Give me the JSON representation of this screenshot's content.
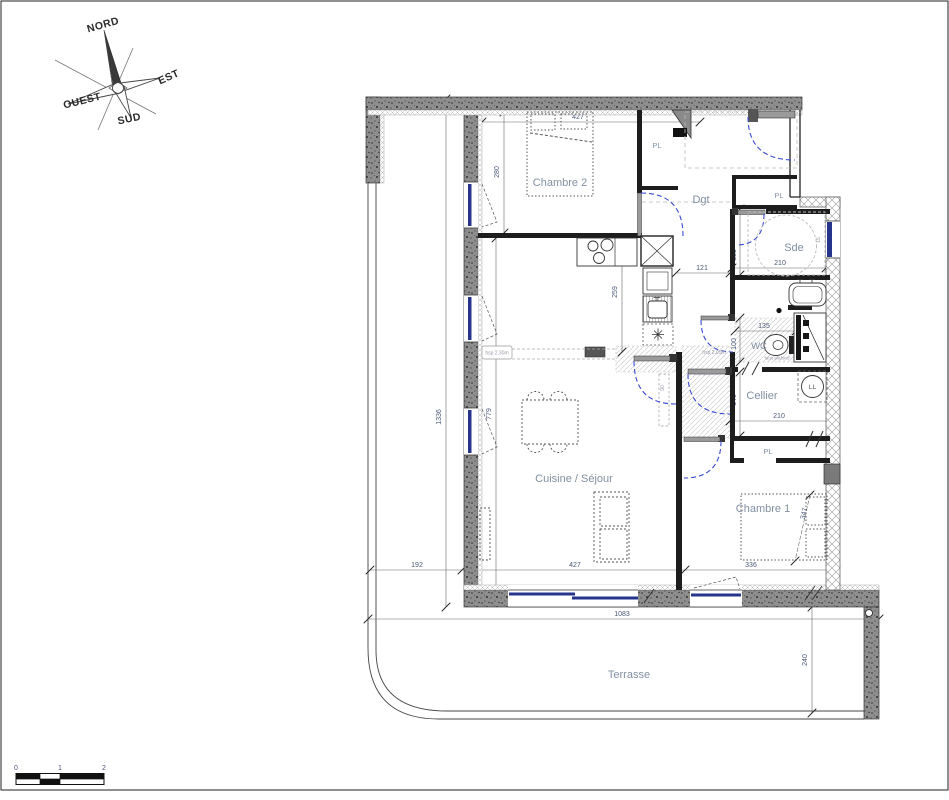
{
  "compass": {
    "north": "NORD",
    "east": "EST",
    "west": "OUEST",
    "south": "SUD"
  },
  "rooms": {
    "chambre2": "Chambre 2",
    "dgt": "Dgt",
    "sde": "Sde",
    "wc": "WC",
    "cellier": "Cellier",
    "cuisine_sejour": "Cuisine / Séjour",
    "chambre1": "Chambre 1",
    "terrasse": "Terrasse",
    "closet_dgt": "PL",
    "closet_entry": "PL",
    "closet_chambre1": "PL",
    "washer": "LL"
  },
  "dims": {
    "apt_height": "1336",
    "chambre2_width": "427",
    "chambre2_height": "280",
    "kitchen_depth": "259",
    "kitchen_passage": "121",
    "sde_depth": "135",
    "sde_width": "210",
    "sde_window": "15",
    "wc_width": "135",
    "wc_depth": "100",
    "corridor_door": "90",
    "cellier_depth": "140",
    "cellier_width": "210",
    "chambre1_depth": "347",
    "chambre1_width": "336",
    "sejour_depth": "779",
    "sejour_width": "427",
    "left_offset": "192",
    "terrasse_width": "1083",
    "terrasse_depth": "240"
  },
  "annotations": {
    "hsp_sejour": "hsp 2.30m",
    "hsp_corridor": "hsp 2.05m",
    "faux_plafond_corridor": "faux plafond",
    "faux_plafond_wc": "faux plafond"
  },
  "scale_bar": {
    "zero": "0",
    "one": "1",
    "two": "2"
  },
  "colors": {
    "wall_concrete": "#8e8e8e",
    "partition_black": "#1d1d1d",
    "window_blue": "#27348b",
    "door_arc_blue": "#3a4bd0",
    "dim_text": "#4a5878",
    "room_label": "#8290a2"
  }
}
